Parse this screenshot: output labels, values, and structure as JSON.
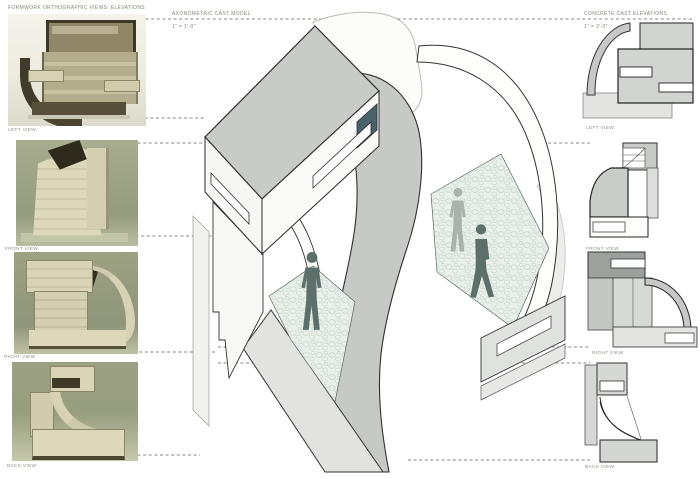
{
  "header": {
    "left_title": "FORMWORK ORTHOGRAPHIC VIEWS: ELEVATIONS",
    "center_title": "AXONOMETRIC CAST MODEL",
    "center_scale": "1\" = 1'-0\"",
    "right_title": "CONCRETE CAST ELEVATIONS",
    "right_scale": "1\" = 3'-0\""
  },
  "left_column": {
    "section": "formwork-model-photographs",
    "photos": [
      {
        "label": "LEFT VIEW"
      },
      {
        "label": "FRONT VIEW"
      },
      {
        "label": "RIGHT VIEW"
      },
      {
        "label": "BACK VIEW"
      }
    ]
  },
  "axon": {
    "description": "cutaway axonometric of concrete cast model with vaulted interior",
    "figure_count": 3,
    "figure_solid_color": "#5c6f6b",
    "figure_ghost_color": "#a7b3ac",
    "opening_accent_color": "#4a636a"
  },
  "right_column": {
    "section": "concrete-cast-elevation-drawings",
    "elevations": [
      {
        "label": "LEFT VIEW"
      },
      {
        "label": "FRONT VIEW"
      },
      {
        "label": "RIGHT VIEW"
      },
      {
        "label": "BACK VIEW"
      }
    ]
  },
  "colors": {
    "paper": "#ffffff",
    "drawing_gray": "#c9cbc9",
    "light_gray": "#e2e3e1",
    "line": "#2b2b2b",
    "leader_dash": "#666666",
    "floor_texture_base": "#e9f0ea",
    "photo_olive": "#9ba183",
    "photo_cream": "#d9d3b6"
  }
}
